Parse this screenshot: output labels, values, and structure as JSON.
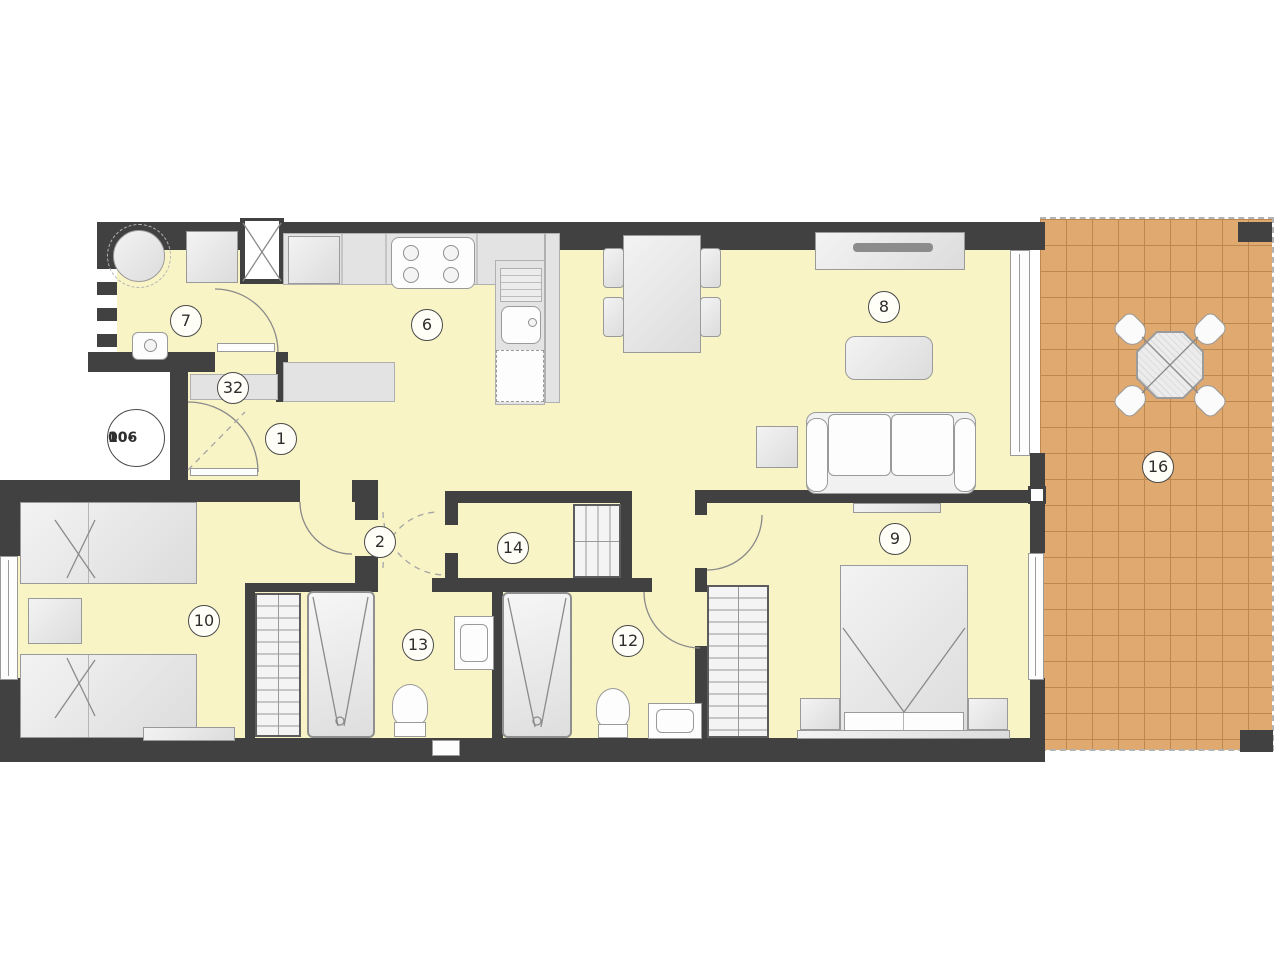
{
  "plan": {
    "type": "apartment-floor-plan",
    "unit_id": {
      "line1": "10-",
      "line2": "006"
    },
    "labels": [
      {
        "num": "1",
        "name": "entry-hall",
        "x": 281,
        "y": 439
      },
      {
        "num": "2",
        "name": "hallway",
        "x": 380,
        "y": 542
      },
      {
        "num": "6",
        "name": "kitchen",
        "x": 427,
        "y": 325
      },
      {
        "num": "7",
        "name": "laundry",
        "x": 186,
        "y": 321
      },
      {
        "num": "8",
        "name": "living-room",
        "x": 884,
        "y": 307
      },
      {
        "num": "9",
        "name": "bedroom-main",
        "x": 895,
        "y": 539
      },
      {
        "num": "10",
        "name": "bedroom-2",
        "x": 204,
        "y": 621
      },
      {
        "num": "12",
        "name": "bathroom-2",
        "x": 628,
        "y": 641
      },
      {
        "num": "13",
        "name": "bathroom-1",
        "x": 418,
        "y": 645
      },
      {
        "num": "14",
        "name": "storage",
        "x": 513,
        "y": 548
      },
      {
        "num": "16",
        "name": "terrace",
        "x": 1158,
        "y": 467
      },
      {
        "num": "32",
        "name": "hall-closet",
        "x": 233,
        "y": 388
      }
    ],
    "colors": {
      "wall": "#414141",
      "floor": "#f8f4c5",
      "terrace": "#dfa96f",
      "terrace_grid": "#bd8850",
      "furniture_border": "#9a9a9a"
    }
  }
}
